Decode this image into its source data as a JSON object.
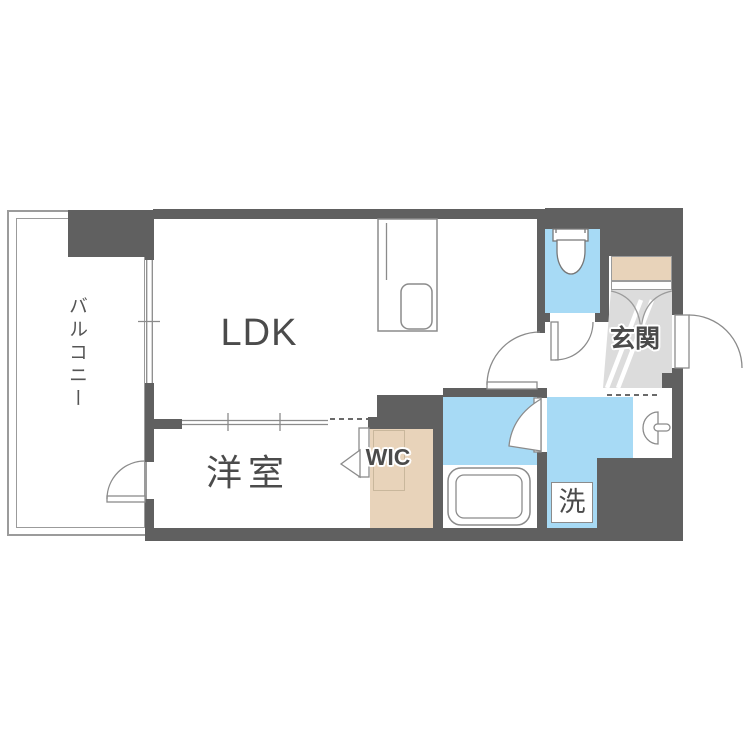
{
  "plan_title": "1LDK apartment floor plan",
  "rooms": {
    "balcony": {
      "label": "バルコニー"
    },
    "ldk": {
      "label": "LDK"
    },
    "western_room": {
      "label": "洋室"
    },
    "wic": {
      "label": "WIC"
    },
    "entrance": {
      "label": "玄関"
    },
    "laundry": {
      "label": "洗"
    }
  },
  "fixtures": [
    "kitchen-counter",
    "kitchen-sink",
    "toilet",
    "bathtub",
    "washbasin",
    "washing-machine-space",
    "shoe-cabinet",
    "entrance-door",
    "swing-door",
    "sliding-door",
    "window",
    "balcony-rail"
  ],
  "colors": {
    "wall": "#606060",
    "water_area": "#a7daf5",
    "wood_area": "#e8d3ba",
    "entry_floor": "#dcdcdc",
    "line": "#8b8b8b",
    "text": "#4b4b4b"
  }
}
